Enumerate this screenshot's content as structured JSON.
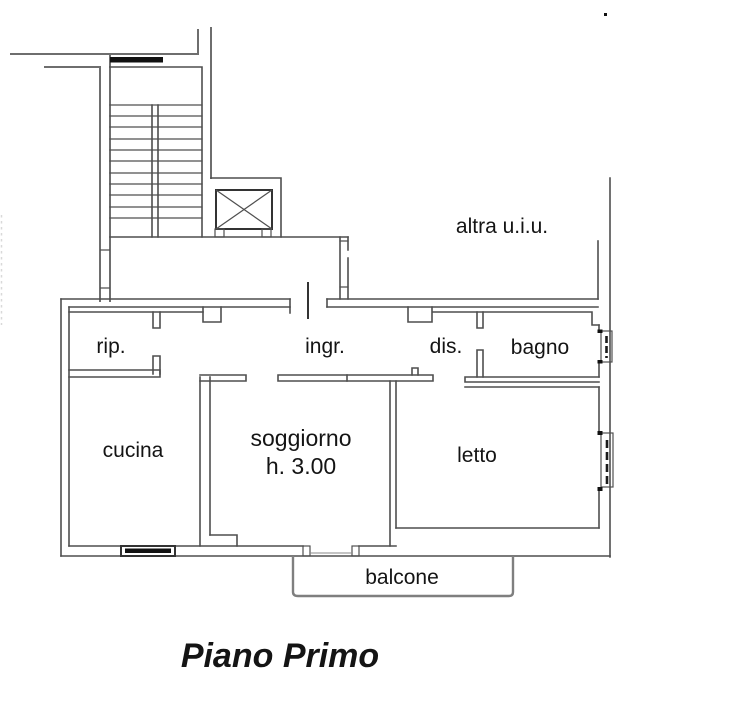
{
  "title": "Piano Primo",
  "plan": {
    "labels": {
      "storage": "rip.",
      "entrance": "ingr.",
      "hallway": "dis.",
      "bathroom": "bagno",
      "kitchen": "cucina",
      "living_room_line1": "soggiorno",
      "living_room_line2": "h. 3.00",
      "bedroom": "letto",
      "balcony": "balcone",
      "other_unit": "altra u.i.u."
    },
    "colors": {
      "wall": "#4f4f4f",
      "dark_elements": "#111111",
      "neighbor_walls": "#6e6e6e",
      "balcony_outline": "#7f7f7f",
      "text": "#141414",
      "background": "#ffffff"
    }
  }
}
